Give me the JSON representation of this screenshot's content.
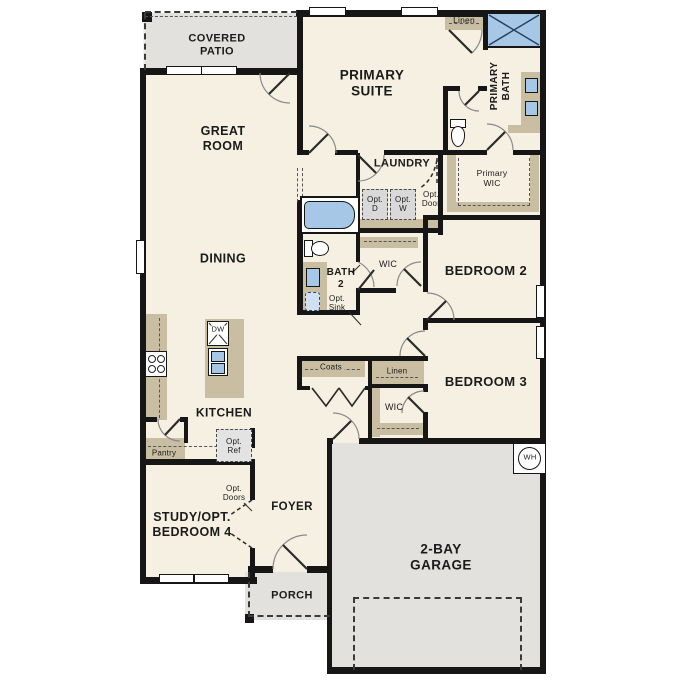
{
  "colors": {
    "floor": "#f6f0e2",
    "casework_tan": "#c9bda2",
    "exterior_gray": "#e2e1dd",
    "fixture_blue": "#a7c7e7",
    "wall_black": "#161616"
  },
  "labels": {
    "covered_patio": "COVERED\nPATIO",
    "great_room": "GREAT\nROOM",
    "primary_suite": "PRIMARY\nSUITE",
    "linen_top": "Linen",
    "primary_bath": "PRIMARY\nBATH",
    "laundry": "LAUNDRY",
    "opt_door": "Opt.\nDoor",
    "opt_d": "Opt.\nD",
    "opt_w": "Opt.\nW",
    "primary_wic": "Primary\nWIC",
    "dining": "DINING",
    "bath_2": "BATH\n2",
    "opt_sink": "Opt.\nSink",
    "wic_bedroom2": "WIC",
    "bedroom_2": "BEDROOM 2",
    "bedroom_3": "BEDROOM 3",
    "coats": "Coats",
    "linen_hall": "Linen",
    "wic_bedroom3": "WIC",
    "kitchen": "KITCHEN",
    "dishwasher": "DW",
    "pantry": "Pantry",
    "opt_ref": "Opt.\nRef",
    "opt_doors": "Opt.\nDoors",
    "study": "STUDY/OPT.\nBEDROOM 4",
    "foyer": "FOYER",
    "porch": "PORCH",
    "garage": "2-BAY\nGARAGE",
    "water_heater": "WH"
  }
}
